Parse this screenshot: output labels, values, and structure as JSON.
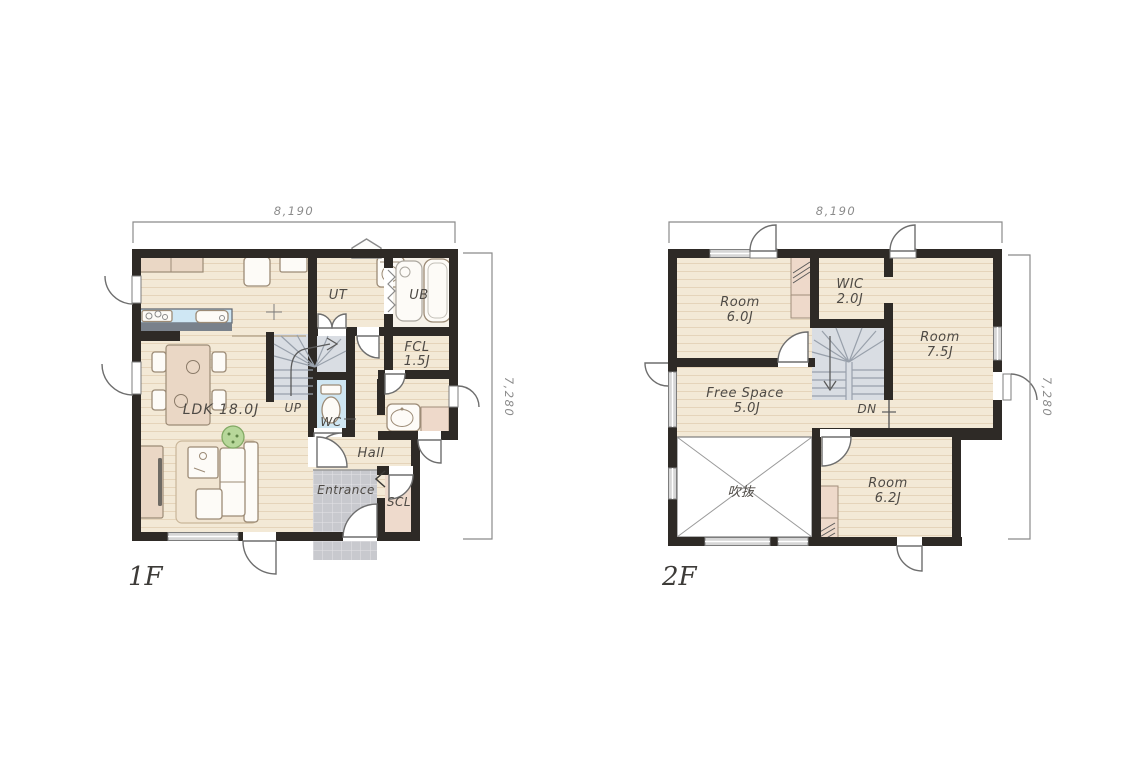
{
  "drawing": {
    "type": "residential floor plan, two storeys side by side",
    "colors": {
      "wall": "#2e2a26",
      "floor": "#f3e9d6",
      "plank_line": "#e5d4ba",
      "kitchen_counter": "#cfe7f4",
      "wc_floor": "#cfe6f2",
      "stair_floor": "#d9dde3",
      "entrance_tile": "#c8c9ce",
      "scl_floor": "#eedacc",
      "closet": "#eed9ca",
      "furniture_tan": "#ead7c5",
      "plant": "#b7d79a",
      "label_text": "#4e4a45",
      "dimension_text": "#8b8b8b"
    }
  },
  "floor1": {
    "name": "1F",
    "dim_top": "8,190",
    "dim_right": "7,280",
    "labels": {
      "ldk": "LDK 18.0J",
      "ut": "UT",
      "ub": "UB",
      "fcl_1": "FCL",
      "fcl_2": "1.5J",
      "wc": "WC",
      "up": "UP",
      "hall": "Hall",
      "entrance": "Entrance",
      "scl": "SCL"
    }
  },
  "floor2": {
    "name": "2F",
    "dim_top": "8,190",
    "dim_right": "7,280",
    "labels": {
      "room_a_1": "Room",
      "room_a_2": "6.0J",
      "wic_1": "WIC",
      "wic_2": "2.0J",
      "room_b_1": "Room",
      "room_b_2": "7.5J",
      "free_1": "Free Space",
      "free_2": "5.0J",
      "dn": "DN",
      "void": "吹抜",
      "room_c_1": "Room",
      "room_c_2": "6.2J"
    }
  }
}
